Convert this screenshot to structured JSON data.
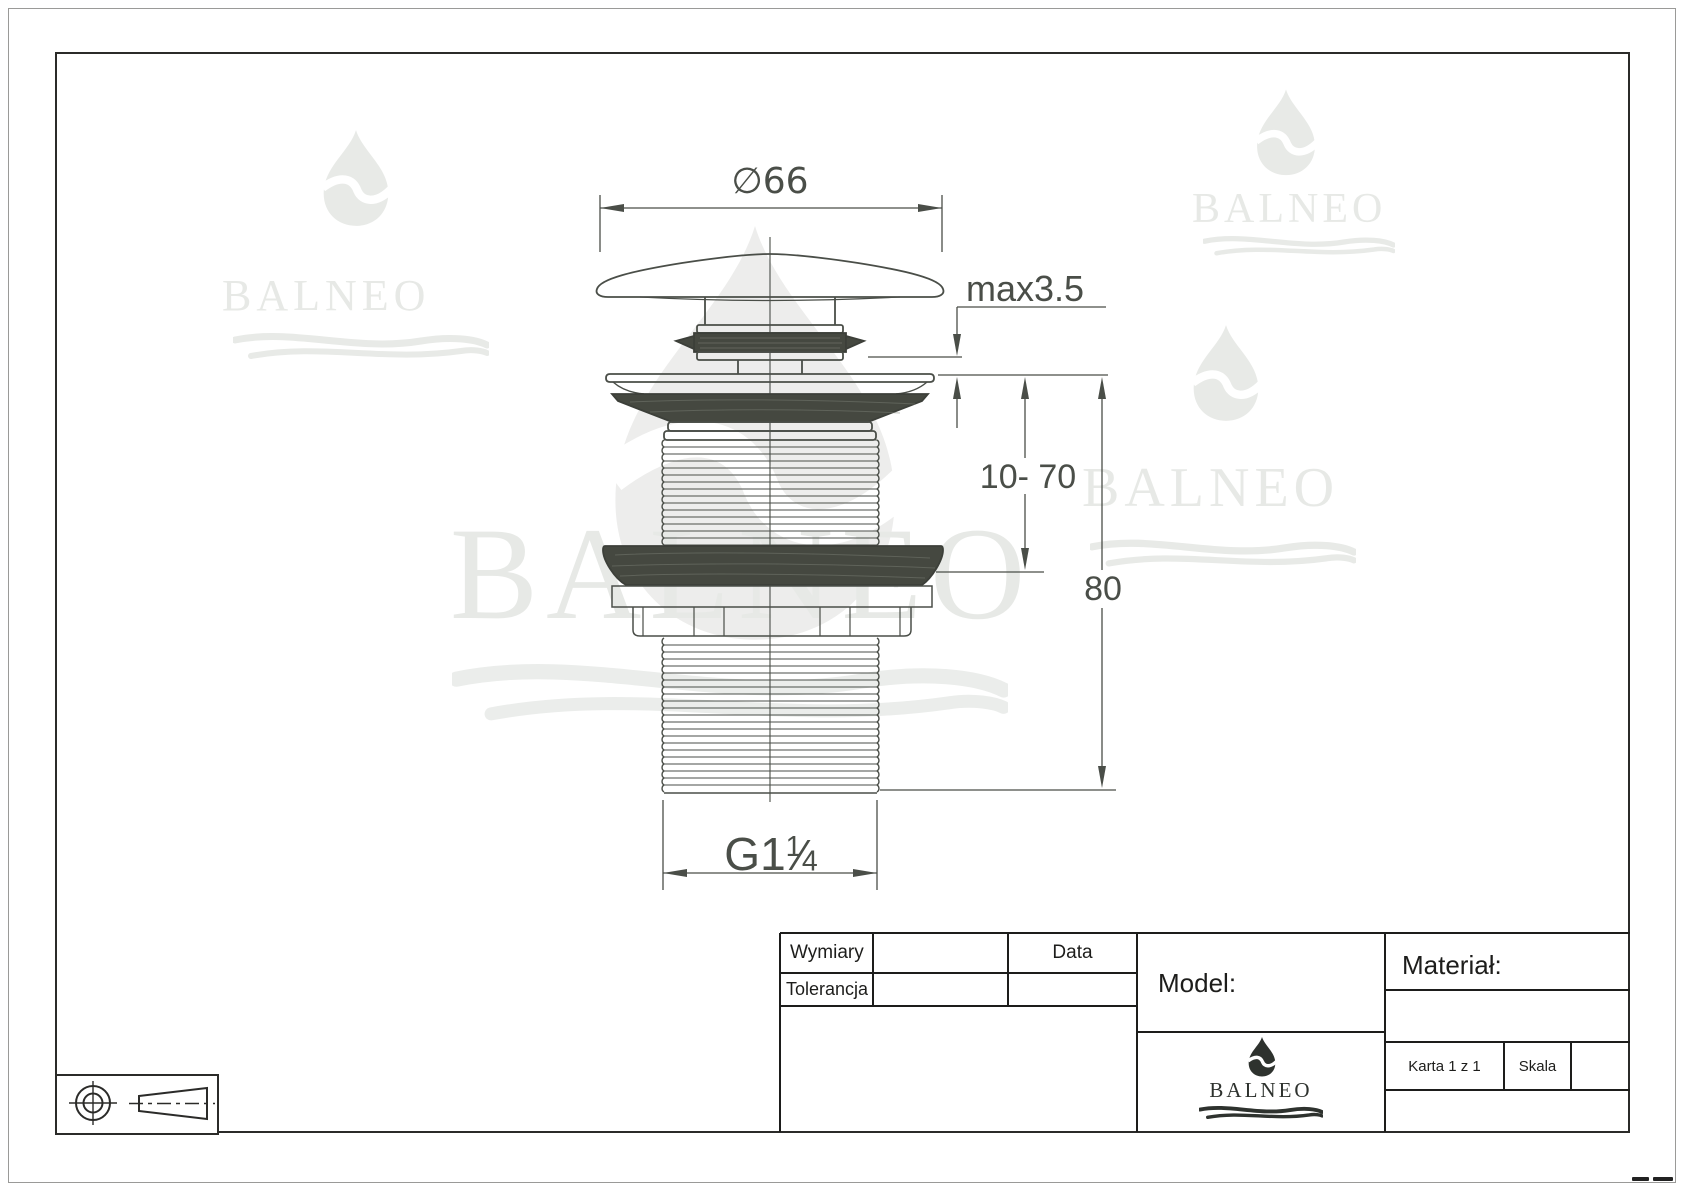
{
  "drawing": {
    "dim_diameter": "∅66",
    "dim_max": "max3.5",
    "dim_range": "10- 70",
    "dim_total": "80",
    "thread": {
      "prefix": "G1",
      "numerator": "1",
      "slash": "⁄",
      "denominator": "4"
    }
  },
  "title_block": {
    "wymiary": "Wymiary",
    "tolerancja": "Tolerancja",
    "data": "Data",
    "model": "Model:",
    "material": "Materiał:",
    "karta": "Karta 1 z 1",
    "skala": "Skala"
  },
  "brand": {
    "name": "BALNEO"
  },
  "colors": {
    "line": "#4a4e48",
    "dark_fill": "#454840",
    "watermark": "#e8eae7",
    "ink": "#1d1d1b"
  }
}
